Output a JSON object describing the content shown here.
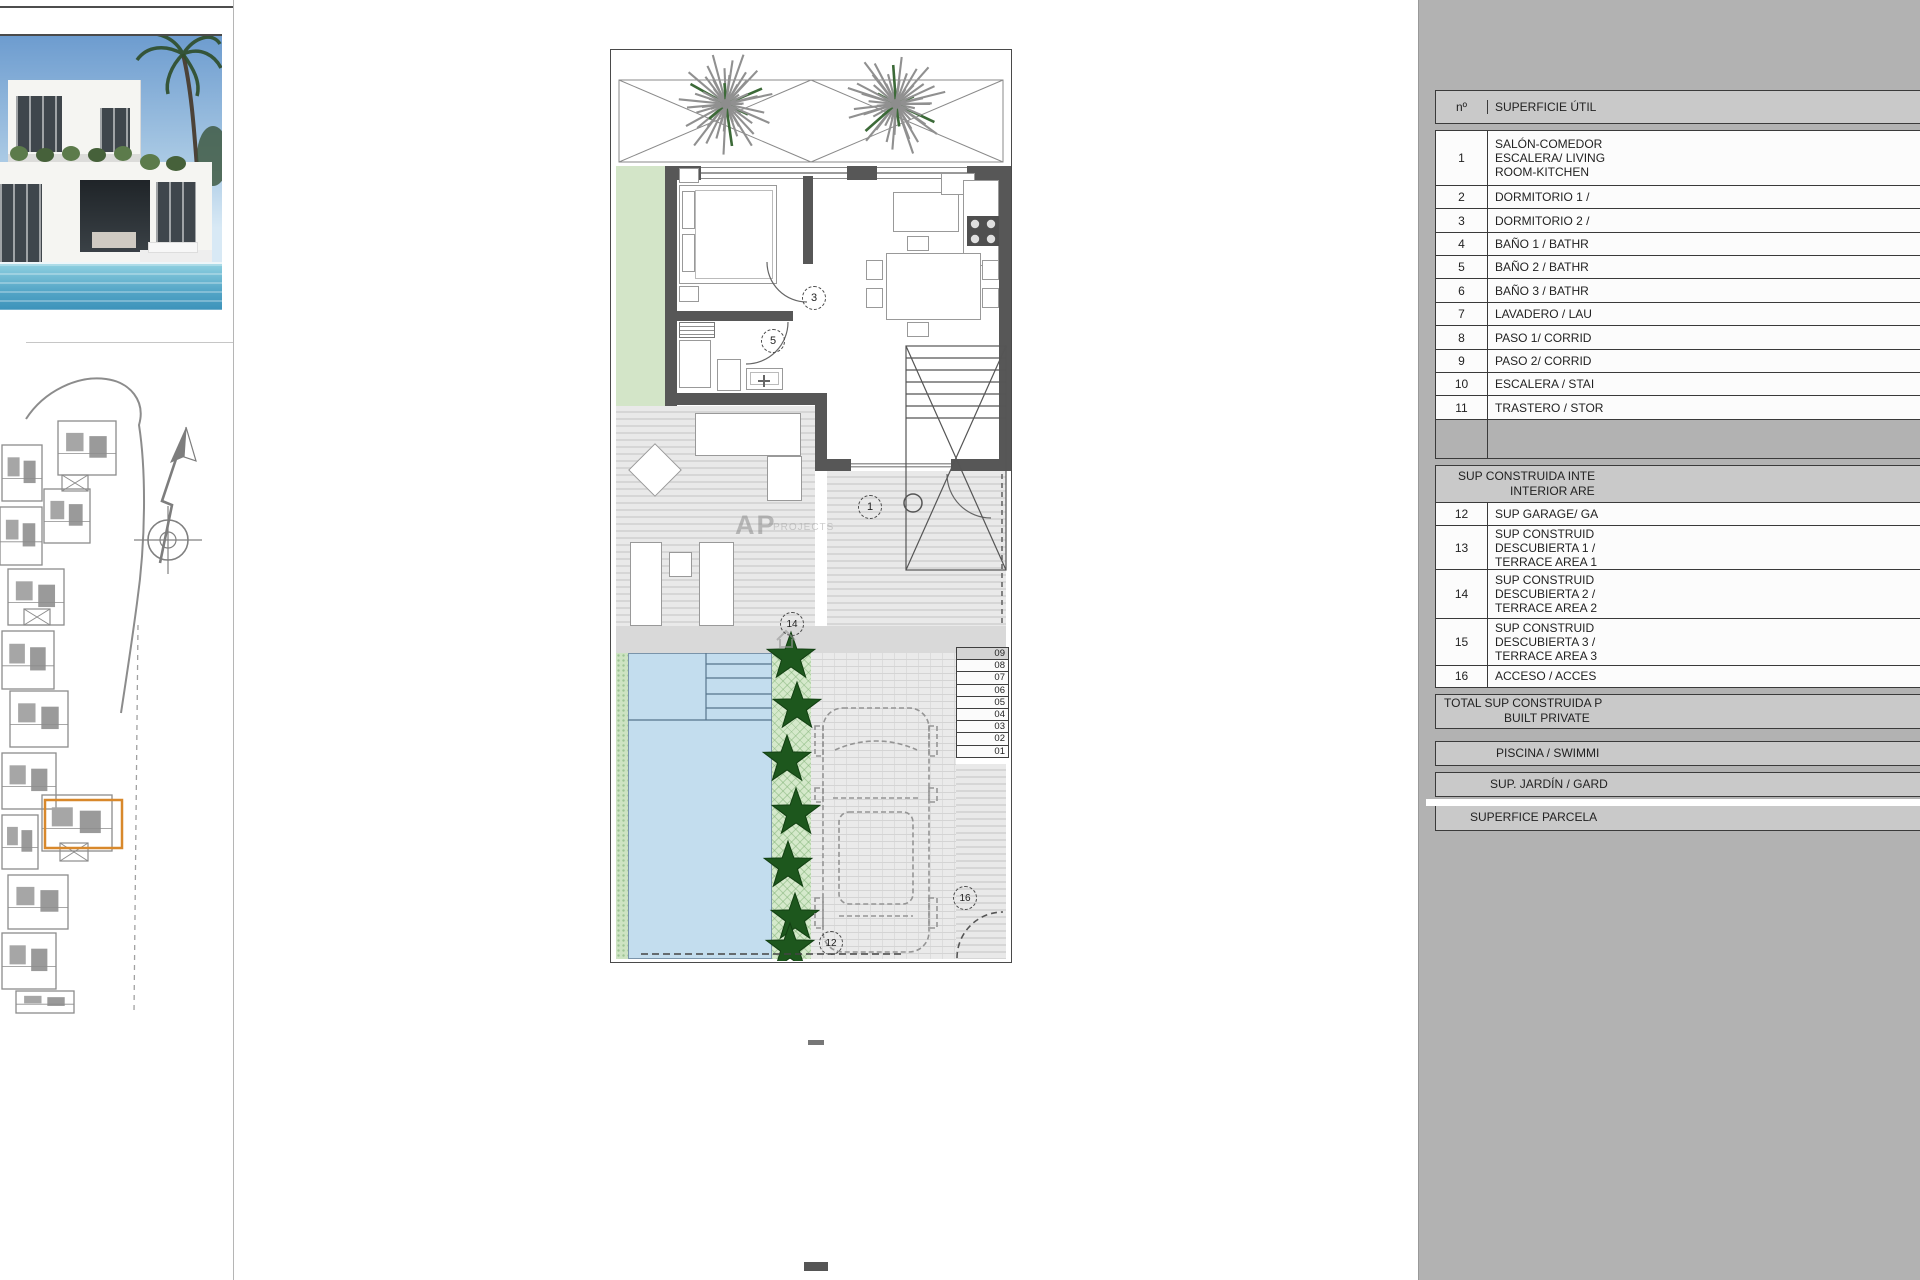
{
  "plan": {
    "labels": {
      "l3": "3",
      "l5": "5",
      "l1": "1",
      "l14": "14",
      "l12": "12",
      "l16": "16"
    },
    "steps": [
      "09",
      "08",
      "07",
      "06",
      "05",
      "04",
      "03",
      "02",
      "01"
    ],
    "watermark": {
      "main": "AP",
      "sub": "PROJECTS"
    }
  },
  "legend": {
    "header": {
      "num": "nº",
      "title": "SUPERFICIE ÚTIL"
    },
    "rows1": [
      {
        "num": "1",
        "lines": [
          "SALÓN-COMEDOR",
          "ESCALERA/ LIVING",
          "ROOM-KITCHEN"
        ]
      },
      {
        "num": "2",
        "lines": [
          "DORMITORIO 1 /"
        ]
      },
      {
        "num": "3",
        "lines": [
          "DORMITORIO 2 /"
        ]
      },
      {
        "num": "4",
        "lines": [
          "BAÑO 1 / BATHR"
        ]
      },
      {
        "num": "5",
        "lines": [
          "BAÑO 2 / BATHR"
        ]
      },
      {
        "num": "6",
        "lines": [
          "BAÑO 3 / BATHR"
        ]
      },
      {
        "num": "7",
        "lines": [
          "LAVADERO / LAU"
        ]
      },
      {
        "num": "8",
        "lines": [
          "PASO 1/ CORRID"
        ]
      },
      {
        "num": "9",
        "lines": [
          "PASO 2/ CORRID"
        ]
      },
      {
        "num": "10",
        "lines": [
          "ESCALERA / STAI"
        ]
      },
      {
        "num": "11",
        "lines": [
          "TRASTERO / STOR"
        ]
      }
    ],
    "section2": {
      "lines": [
        "SUP CONSTRUIDA INTE",
        "INTERIOR ARE"
      ]
    },
    "rows2": [
      {
        "num": "12",
        "lines": [
          "SUP GARAGE/ GA"
        ]
      },
      {
        "num": "13",
        "lines": [
          "SUP CONSTRUID",
          "DESCUBIERTA 1 /",
          "TERRACE AREA 1"
        ]
      },
      {
        "num": "14",
        "lines": [
          "SUP CONSTRUID",
          "DESCUBIERTA 2 /",
          "TERRACE AREA 2"
        ]
      },
      {
        "num": "15",
        "lines": [
          "SUP CONSTRUID",
          "DESCUBIERTA 3 /",
          "TERRACE AREA 3"
        ]
      },
      {
        "num": "16",
        "lines": [
          "ACCESO / ACCES"
        ]
      }
    ],
    "total": {
      "lines": [
        "TOTAL SUP CONSTRUIDA P",
        "BUILT PRIVATE"
      ]
    },
    "boxes": [
      "PISCINA / SWIMMI",
      "SUP. JARDÍN / GARD",
      "SUPERFICE PARCELA"
    ]
  },
  "colors": {
    "accent_orange": "#d8882b",
    "pool_blue": "#c3ddee",
    "hedge_green": "#1d571d",
    "panel_gray": "#b2b2b2",
    "wall_gray": "#575757"
  }
}
